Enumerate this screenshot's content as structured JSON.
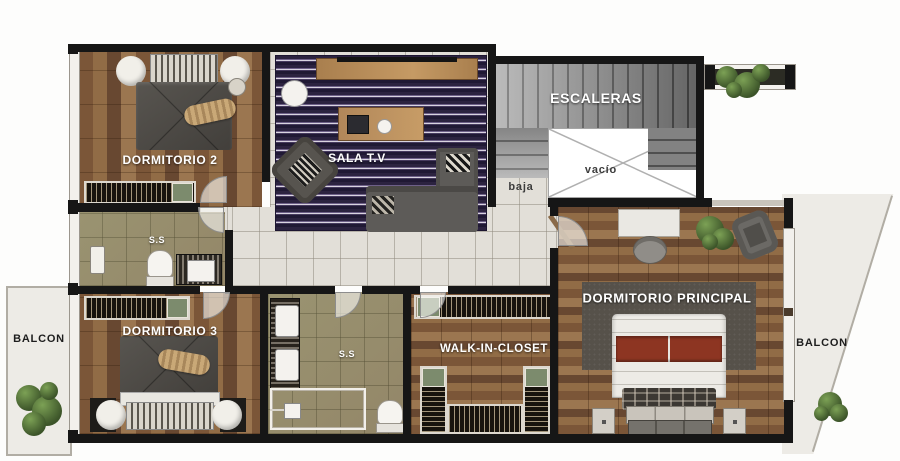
{
  "rooms": {
    "dormitorio2": {
      "label": "DORMITORIO 2"
    },
    "sala_tv": {
      "label": "SALA T.V"
    },
    "escaleras": {
      "label": "ESCALERAS"
    },
    "vacio": {
      "label": "vacío"
    },
    "baja": {
      "label": "baja"
    },
    "ss_upper": {
      "label": "S.S"
    },
    "dormitorio3": {
      "label": "DORMITORIO 3"
    },
    "ss_lower": {
      "label": "S.S"
    },
    "walk_in_closet": {
      "label": "WALK-IN-CLOSET"
    },
    "dormitorio_principal": {
      "label": "DORMITORIO PRINCIPAL"
    },
    "balcon_left": {
      "label": "BALCON"
    },
    "balcon_right": {
      "label": "BALCON"
    }
  },
  "palette": {
    "wall": "#161616",
    "wood": "#83613f",
    "bath_tile": "#a29776",
    "hall_tile": "#e2dfd8",
    "rug_purple": "#392e50",
    "rug_gray": "#56514a",
    "balcony": "#edebe6",
    "bed_red_stripe": "#8d3522",
    "closet_green": "#7c8b6d",
    "plant_green": "#4f6b37"
  }
}
